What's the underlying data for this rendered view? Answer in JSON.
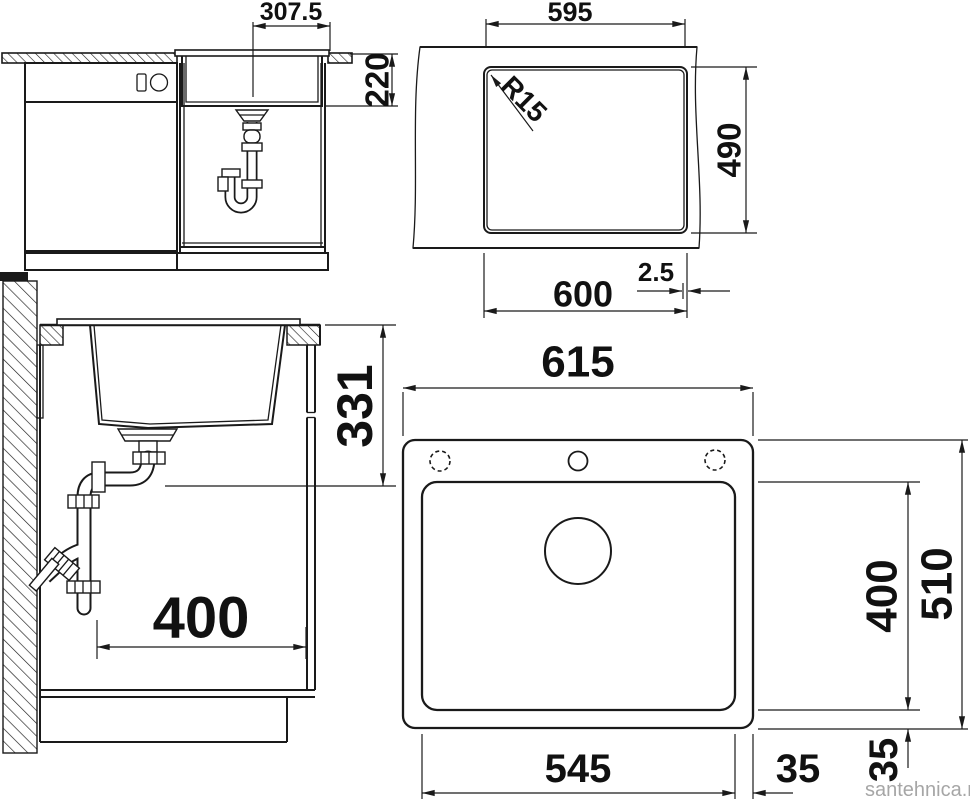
{
  "colors": {
    "line": "#1a1a1a",
    "watermark": "#a6a6a6",
    "background": "#ffffff"
  },
  "watermark": "santehnica.ru",
  "views": {
    "front": {
      "dims": {
        "center_to_edge": "307.5",
        "bowl_depth": "220"
      }
    },
    "cutout": {
      "dims": {
        "inner_width": "595",
        "corner_radius": "R15",
        "depth": "490",
        "outer_width": "600",
        "edge_offset": "2.5"
      }
    },
    "side": {
      "dims": {
        "counter_to_drain_height": "331",
        "wall_to_front_depth": "400"
      }
    },
    "plan": {
      "dims": {
        "overall_width": "615",
        "bowl_depth": "400",
        "overall_depth": "510",
        "bowl_width": "545",
        "side_margin": "35",
        "front_margin": "35"
      }
    }
  }
}
